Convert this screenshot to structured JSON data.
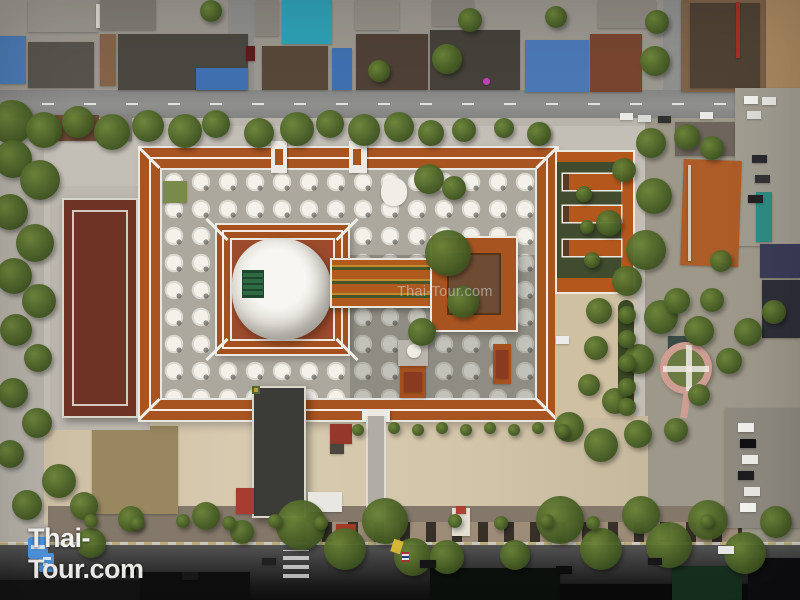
{
  "meta": {
    "description": "Aerial drone photograph of a Thai temple complex (wat) with a large central chedi under restoration, grids of white chedis, orange-roofed galleries, surrounding streets, houses and trees",
    "type": "aerial-photograph"
  },
  "watermark": {
    "text": "Thai-Tour.com"
  },
  "logo": {
    "text": "Thai-Tour.com",
    "icon": "thai-tour-blocks-icon"
  },
  "palette": {
    "gallery_roof_orange": "#a85420",
    "annex_roof_orange": "#b4571c",
    "inner_court_terracotta": "#9c4a2c",
    "left_building_maroon": "#6f3325",
    "chedi_white": "#f3f1ea",
    "pavement": "#b6b2a9",
    "sand": "#d5c7ab",
    "tree_green": "#465c24",
    "road_gray": "#8f8f8d",
    "road_dark": "#141414",
    "teal_roof": "#2fa0b4",
    "blue_roof": "#4a78b5",
    "logo_blue": "#4f94dd",
    "watermark_white": "rgba(255,255,255,0.42)"
  },
  "scene": {
    "base_blocks": [
      {
        "x": 0,
        "y": 36,
        "w": 26,
        "h": 48,
        "c": "#4a79b2"
      },
      {
        "x": 28,
        "y": 0,
        "w": 70,
        "h": 32,
        "c": "#97938b"
      },
      {
        "x": 28,
        "y": 42,
        "w": 66,
        "h": 46,
        "c": "#56524c"
      },
      {
        "x": 96,
        "y": 4,
        "w": 20,
        "h": 24,
        "c": "#d8d5ce"
      },
      {
        "x": 100,
        "y": 0,
        "w": 56,
        "h": 30,
        "c": "#7e7a73"
      },
      {
        "x": 118,
        "y": 34,
        "w": 130,
        "h": 56,
        "c": "#4a4640"
      },
      {
        "x": 196,
        "y": 68,
        "w": 52,
        "h": 22,
        "c": "#3f6fae"
      },
      {
        "x": 100,
        "y": 34,
        "w": 16,
        "h": 52,
        "c": "#836248"
      },
      {
        "x": 255,
        "y": 0,
        "w": 24,
        "h": 36,
        "c": "#8a867e"
      },
      {
        "x": 282,
        "y": 0,
        "w": 50,
        "h": 44,
        "c": "#2fa0b4"
      },
      {
        "x": 262,
        "y": 46,
        "w": 66,
        "h": 44,
        "c": "#574739"
      },
      {
        "x": 332,
        "y": 48,
        "w": 20,
        "h": 42,
        "c": "#3f6fae"
      },
      {
        "x": 355,
        "y": 0,
        "w": 44,
        "h": 30,
        "c": "#928e86"
      },
      {
        "x": 356,
        "y": 34,
        "w": 72,
        "h": 56,
        "c": "#4e4036"
      },
      {
        "x": 430,
        "y": 30,
        "w": 90,
        "h": 60,
        "c": "#45413a"
      },
      {
        "x": 432,
        "y": 0,
        "w": 42,
        "h": 26,
        "c": "#8b877f"
      },
      {
        "x": 525,
        "y": 40,
        "w": 64,
        "h": 52,
        "c": "#4a78b5"
      },
      {
        "x": 590,
        "y": 34,
        "w": 52,
        "h": 58,
        "c": "#77452f"
      },
      {
        "x": 598,
        "y": 0,
        "w": 58,
        "h": 28,
        "c": "#8e8a82"
      },
      {
        "x": 483,
        "y": 78,
        "w": 7,
        "h": 7,
        "c": "#c040c0",
        "br": "50%"
      },
      {
        "x": 681,
        "y": 0,
        "w": 119,
        "h": 92,
        "c": "#7d6248"
      },
      {
        "x": 690,
        "y": 3,
        "w": 70,
        "h": 85,
        "c": "#4e4234"
      },
      {
        "x": 736,
        "y": 2,
        "w": 4,
        "h": 56,
        "c": "#a23026"
      },
      {
        "x": 766,
        "y": 0,
        "w": 34,
        "h": 90,
        "c": "#a8875f"
      },
      {
        "x": 675,
        "y": 122,
        "w": 62,
        "h": 34,
        "c": "#6e665c"
      },
      {
        "x": 739,
        "y": 122,
        "w": 28,
        "h": 32,
        "c": "#7b7369"
      },
      {
        "x": 769,
        "y": 124,
        "w": 31,
        "h": 36,
        "c": "#8e5530"
      },
      {
        "x": 735,
        "y": 88,
        "w": 65,
        "h": 158,
        "c": "#a19c90"
      },
      {
        "x": 682,
        "y": 160,
        "w": 58,
        "h": 106,
        "c": "#ad5c28",
        "r": 2
      },
      {
        "x": 756,
        "y": 192,
        "w": 16,
        "h": 50,
        "c": "#2f8c84"
      },
      {
        "x": 760,
        "y": 244,
        "w": 40,
        "h": 34,
        "c": "#3c3c58"
      },
      {
        "x": 762,
        "y": 280,
        "w": 38,
        "h": 58,
        "c": "#2f2f3a"
      },
      {
        "x": 725,
        "y": 408,
        "w": 75,
        "h": 120,
        "c": "#8f8a80"
      },
      {
        "x": 668,
        "y": 336,
        "w": 28,
        "h": 18,
        "c": "#3a4a44"
      },
      {
        "x": 92,
        "y": 426,
        "w": 86,
        "h": 88,
        "c": "#98875f"
      },
      {
        "x": 55,
        "y": 115,
        "w": 44,
        "h": 26,
        "c": "#6b4a36"
      },
      {
        "x": 102,
        "y": 115,
        "w": 30,
        "h": 26,
        "c": "#87837b"
      }
    ],
    "detail_blocks": [
      {
        "x": 688,
        "y": 165,
        "w": 3,
        "h": 96,
        "c": "#d8c8b0"
      },
      {
        "x": 163,
        "y": 181,
        "w": 24,
        "h": 22,
        "c": "#7a8a4a"
      },
      {
        "x": 381,
        "y": 178,
        "w": 26,
        "h": 28,
        "c": "#f0eee7",
        "br": "45%"
      },
      {
        "x": 493,
        "y": 344,
        "w": 18,
        "h": 40,
        "c": "#a4511f"
      },
      {
        "x": 496,
        "y": 350,
        "w": 12,
        "h": 28,
        "c": "#8a3a20"
      },
      {
        "x": 400,
        "y": 366,
        "w": 26,
        "h": 32,
        "c": "#a4511f"
      },
      {
        "x": 404,
        "y": 372,
        "w": 18,
        "h": 20,
        "c": "#8a3a20"
      },
      {
        "x": 398,
        "y": 340,
        "w": 30,
        "h": 26,
        "c": "#b9b5ac"
      },
      {
        "x": 407,
        "y": 344,
        "w": 14,
        "h": 14,
        "c": "#efede6",
        "br": "50%"
      },
      {
        "x": 330,
        "y": 424,
        "w": 22,
        "h": 20,
        "c": "#93382a"
      },
      {
        "x": 308,
        "y": 492,
        "w": 34,
        "h": 20,
        "c": "#e9e7e1"
      },
      {
        "x": 330,
        "y": 444,
        "w": 14,
        "h": 10,
        "c": "#4a463e"
      },
      {
        "x": 236,
        "y": 488,
        "w": 18,
        "h": 26,
        "c": "#a83c30"
      },
      {
        "x": 452,
        "y": 508,
        "w": 18,
        "h": 28,
        "c": "#e6e0d4"
      },
      {
        "x": 456,
        "y": 506,
        "w": 10,
        "h": 8,
        "c": "#b04034"
      },
      {
        "x": 336,
        "y": 524,
        "w": 20,
        "h": 20,
        "c": "#a33a28"
      },
      {
        "x": 0,
        "y": 580,
        "w": 140,
        "h": 20,
        "c": "#141414"
      },
      {
        "x": 140,
        "y": 572,
        "w": 110,
        "h": 28,
        "c": "#0f0f0f"
      },
      {
        "x": 430,
        "y": 568,
        "w": 130,
        "h": 32,
        "c": "#0c110d"
      },
      {
        "x": 560,
        "y": 584,
        "w": 240,
        "h": 16,
        "c": "#0a0a0a"
      },
      {
        "x": 672,
        "y": 566,
        "w": 70,
        "h": 34,
        "c": "#16301f"
      },
      {
        "x": 748,
        "y": 558,
        "w": 52,
        "h": 42,
        "c": "#0e0e10"
      }
    ],
    "cars": [
      {
        "x": 246,
        "y": 46,
        "w": 9,
        "h": 15,
        "c": "#5a1c1c"
      },
      {
        "x": 620,
        "y": 113,
        "w": 13,
        "h": 7,
        "c": "#e9e9e6"
      },
      {
        "x": 638,
        "y": 115,
        "w": 13,
        "h": 7,
        "c": "#d9d9d5"
      },
      {
        "x": 658,
        "y": 116,
        "w": 13,
        "h": 7,
        "c": "#30302e"
      },
      {
        "x": 700,
        "y": 112,
        "w": 13,
        "h": 7,
        "c": "#e9e9e6"
      },
      {
        "x": 744,
        "y": 96,
        "w": 14,
        "h": 8,
        "c": "#f0f0ed"
      },
      {
        "x": 762,
        "y": 97,
        "w": 14,
        "h": 8,
        "c": "#e6e6e2"
      },
      {
        "x": 747,
        "y": 111,
        "w": 14,
        "h": 8,
        "c": "#dcdcd8"
      },
      {
        "x": 752,
        "y": 155,
        "w": 15,
        "h": 8,
        "c": "#2a2a2e"
      },
      {
        "x": 755,
        "y": 175,
        "w": 15,
        "h": 8,
        "c": "#333336"
      },
      {
        "x": 748,
        "y": 195,
        "w": 15,
        "h": 8,
        "c": "#232326"
      },
      {
        "x": 556,
        "y": 336,
        "w": 13,
        "h": 8,
        "c": "#ececea"
      },
      {
        "x": 738,
        "y": 423,
        "w": 16,
        "h": 9,
        "c": "#f0efec"
      },
      {
        "x": 740,
        "y": 439,
        "w": 16,
        "h": 9,
        "c": "#121214"
      },
      {
        "x": 742,
        "y": 455,
        "w": 16,
        "h": 9,
        "c": "#eeede9"
      },
      {
        "x": 738,
        "y": 471,
        "w": 16,
        "h": 9,
        "c": "#1e1e20"
      },
      {
        "x": 744,
        "y": 487,
        "w": 16,
        "h": 9,
        "c": "#e9e8e4"
      },
      {
        "x": 740,
        "y": 503,
        "w": 16,
        "h": 9,
        "c": "#f3f3ef"
      },
      {
        "x": 118,
        "y": 566,
        "w": 18,
        "h": 9,
        "c": "#111111"
      },
      {
        "x": 182,
        "y": 572,
        "w": 16,
        "h": 8,
        "c": "#1a1a1a"
      },
      {
        "x": 262,
        "y": 558,
        "w": 14,
        "h": 7,
        "c": "#222222"
      },
      {
        "x": 420,
        "y": 560,
        "w": 16,
        "h": 8,
        "c": "#161616"
      },
      {
        "x": 556,
        "y": 566,
        "w": 16,
        "h": 8,
        "c": "#0e0e0e"
      },
      {
        "x": 648,
        "y": 558,
        "w": 14,
        "h": 7,
        "c": "#181818"
      },
      {
        "x": 718,
        "y": 546,
        "w": 16,
        "h": 8,
        "c": "#e8e8e5"
      }
    ],
    "trees": [
      {
        "x": -10,
        "y": 100,
        "d": 44
      },
      {
        "x": 26,
        "y": 112,
        "d": 36
      },
      {
        "x": 62,
        "y": 106,
        "d": 32
      },
      {
        "x": 94,
        "y": 114,
        "d": 36
      },
      {
        "x": 132,
        "y": 110,
        "d": 32
      },
      {
        "x": 168,
        "y": 114,
        "d": 34
      },
      {
        "x": 202,
        "y": 110,
        "d": 28
      },
      {
        "x": 244,
        "y": 118,
        "d": 30
      },
      {
        "x": 280,
        "y": 112,
        "d": 34
      },
      {
        "x": 316,
        "y": 110,
        "d": 28
      },
      {
        "x": 348,
        "y": 114,
        "d": 32
      },
      {
        "x": 384,
        "y": 112,
        "d": 30
      },
      {
        "x": 418,
        "y": 120,
        "d": 26
      },
      {
        "x": 452,
        "y": 118,
        "d": 24
      },
      {
        "x": 494,
        "y": 118,
        "d": 20
      },
      {
        "x": 530,
        "y": 122,
        "d": 20
      },
      {
        "x": 432,
        "y": 44,
        "d": 30
      },
      {
        "x": 458,
        "y": 8,
        "d": 24
      },
      {
        "x": 545,
        "y": 6,
        "d": 22
      },
      {
        "x": 640,
        "y": 46,
        "d": 30
      },
      {
        "x": 645,
        "y": 10,
        "d": 24
      },
      {
        "x": 368,
        "y": 60,
        "d": 22
      },
      {
        "x": 200,
        "y": 0,
        "d": 22
      },
      {
        "x": -6,
        "y": 140,
        "d": 38
      },
      {
        "x": 20,
        "y": 160,
        "d": 40
      },
      {
        "x": -8,
        "y": 194,
        "d": 36
      },
      {
        "x": 16,
        "y": 224,
        "d": 38
      },
      {
        "x": -4,
        "y": 258,
        "d": 36
      },
      {
        "x": 22,
        "y": 284,
        "d": 34
      },
      {
        "x": 0,
        "y": 314,
        "d": 32
      },
      {
        "x": 24,
        "y": 344,
        "d": 28
      },
      {
        "x": -2,
        "y": 378,
        "d": 30
      },
      {
        "x": 22,
        "y": 408,
        "d": 30
      },
      {
        "x": -4,
        "y": 440,
        "d": 28
      },
      {
        "x": 42,
        "y": 464,
        "d": 34
      },
      {
        "x": 12,
        "y": 490,
        "d": 30
      },
      {
        "x": 70,
        "y": 492,
        "d": 28
      },
      {
        "x": 636,
        "y": 128,
        "d": 30
      },
      {
        "x": 674,
        "y": 124,
        "d": 26
      },
      {
        "x": 612,
        "y": 158,
        "d": 24
      },
      {
        "x": 636,
        "y": 178,
        "d": 36
      },
      {
        "x": 596,
        "y": 210,
        "d": 26
      },
      {
        "x": 626,
        "y": 230,
        "d": 40
      },
      {
        "x": 612,
        "y": 266,
        "d": 30
      },
      {
        "x": 586,
        "y": 298,
        "d": 26
      },
      {
        "x": 644,
        "y": 300,
        "d": 34
      },
      {
        "x": 584,
        "y": 336,
        "d": 24
      },
      {
        "x": 624,
        "y": 344,
        "d": 30
      },
      {
        "x": 664,
        "y": 288,
        "d": 26
      },
      {
        "x": 684,
        "y": 316,
        "d": 30
      },
      {
        "x": 578,
        "y": 374,
        "d": 22
      },
      {
        "x": 602,
        "y": 388,
        "d": 26
      },
      {
        "x": 554,
        "y": 412,
        "d": 30
      },
      {
        "x": 584,
        "y": 428,
        "d": 34
      },
      {
        "x": 624,
        "y": 420,
        "d": 28
      },
      {
        "x": 664,
        "y": 418,
        "d": 24
      },
      {
        "x": 700,
        "y": 288,
        "d": 24
      },
      {
        "x": 716,
        "y": 348,
        "d": 26
      },
      {
        "x": 688,
        "y": 384,
        "d": 22
      },
      {
        "x": 734,
        "y": 318,
        "d": 28
      },
      {
        "x": 762,
        "y": 300,
        "d": 24
      },
      {
        "x": 700,
        "y": 136,
        "d": 24
      },
      {
        "x": 710,
        "y": 250,
        "d": 22
      },
      {
        "x": 276,
        "y": 500,
        "d": 50
      },
      {
        "x": 324,
        "y": 528,
        "d": 42
      },
      {
        "x": 362,
        "y": 498,
        "d": 46
      },
      {
        "x": 394,
        "y": 538,
        "d": 38
      },
      {
        "x": 536,
        "y": 496,
        "d": 48
      },
      {
        "x": 580,
        "y": 528,
        "d": 42
      },
      {
        "x": 622,
        "y": 496,
        "d": 38
      },
      {
        "x": 646,
        "y": 522,
        "d": 46
      },
      {
        "x": 688,
        "y": 500,
        "d": 40
      },
      {
        "x": 724,
        "y": 532,
        "d": 42
      },
      {
        "x": 760,
        "y": 506,
        "d": 32
      },
      {
        "x": 192,
        "y": 502,
        "d": 28
      },
      {
        "x": 230,
        "y": 520,
        "d": 24
      },
      {
        "x": 118,
        "y": 506,
        "d": 26
      },
      {
        "x": 76,
        "y": 528,
        "d": 30
      },
      {
        "x": 430,
        "y": 540,
        "d": 34
      },
      {
        "x": 500,
        "y": 540,
        "d": 30
      },
      {
        "x": 425,
        "y": 230,
        "d": 46
      },
      {
        "x": 447,
        "y": 286,
        "d": 32
      },
      {
        "x": 408,
        "y": 318,
        "d": 28
      },
      {
        "x": 414,
        "y": 164,
        "d": 30
      },
      {
        "x": 442,
        "y": 176,
        "d": 24
      },
      {
        "x": 527,
        "y": 122,
        "d": 24
      },
      {
        "x": 576,
        "y": 186,
        "d": 16
      },
      {
        "x": 580,
        "y": 220,
        "d": 14
      },
      {
        "x": 584,
        "y": 252,
        "d": 16
      },
      {
        "x": 618,
        "y": 306,
        "d": 18
      },
      {
        "x": 618,
        "y": 330,
        "d": 18
      },
      {
        "x": 618,
        "y": 354,
        "d": 18
      },
      {
        "x": 618,
        "y": 378,
        "d": 18
      },
      {
        "x": 618,
        "y": 398,
        "d": 18
      },
      {
        "x": 352,
        "y": 424,
        "d": 12
      },
      {
        "x": 388,
        "y": 422,
        "d": 12
      },
      {
        "x": 412,
        "y": 424,
        "d": 12
      },
      {
        "x": 436,
        "y": 422,
        "d": 12
      },
      {
        "x": 460,
        "y": 424,
        "d": 12
      },
      {
        "x": 484,
        "y": 422,
        "d": 12
      },
      {
        "x": 508,
        "y": 424,
        "d": 12
      },
      {
        "x": 532,
        "y": 422,
        "d": 12
      },
      {
        "x": 556,
        "y": 424,
        "d": 14
      },
      {
        "x": 84,
        "y": 514,
        "d": 14
      },
      {
        "x": 130,
        "y": 516,
        "d": 14
      },
      {
        "x": 176,
        "y": 514,
        "d": 14
      },
      {
        "x": 222,
        "y": 516,
        "d": 14
      },
      {
        "x": 268,
        "y": 514,
        "d": 14
      },
      {
        "x": 314,
        "y": 516,
        "d": 14
      },
      {
        "x": 448,
        "y": 514,
        "d": 14
      },
      {
        "x": 494,
        "y": 516,
        "d": 14
      },
      {
        "x": 540,
        "y": 514,
        "d": 14
      },
      {
        "x": 586,
        "y": 516,
        "d": 14
      },
      {
        "x": 700,
        "y": 514,
        "d": 14
      }
    ]
  }
}
